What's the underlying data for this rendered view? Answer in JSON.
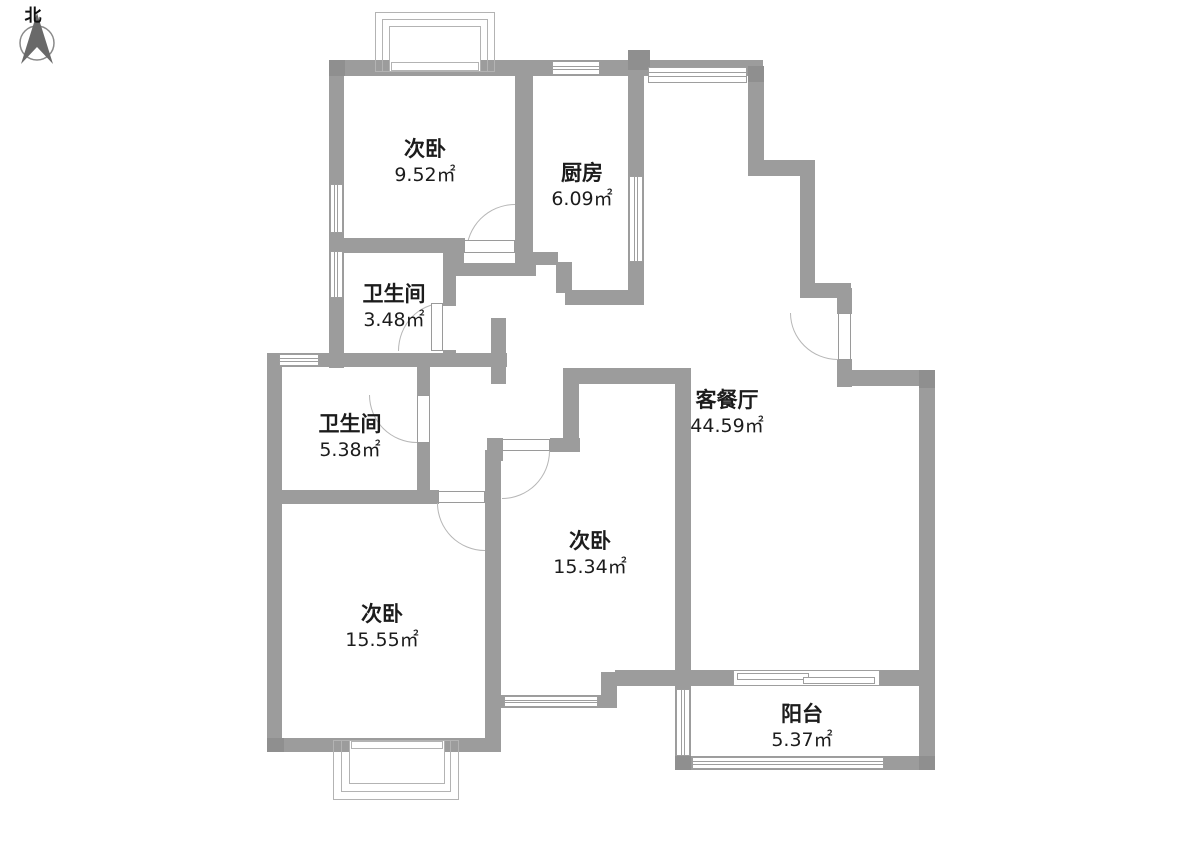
{
  "compass": {
    "label": "北"
  },
  "rooms": [
    {
      "id": "bedroom-north",
      "name": "次卧",
      "area": "9.52㎡"
    },
    {
      "id": "kitchen",
      "name": "厨房",
      "area": "6.09㎡"
    },
    {
      "id": "bathroom-north",
      "name": "卫生间",
      "area": "3.48㎡"
    },
    {
      "id": "bathroom-south",
      "name": "卫生间",
      "area": "5.38㎡"
    },
    {
      "id": "living-dining",
      "name": "客餐厅",
      "area": "44.59㎡"
    },
    {
      "id": "bedroom-middle",
      "name": "次卧",
      "area": "15.34㎡"
    },
    {
      "id": "bedroom-west",
      "name": "次卧",
      "area": "15.55㎡"
    },
    {
      "id": "balcony",
      "name": "阳台",
      "area": "5.37㎡"
    }
  ],
  "colors": {
    "wall": "#9c9c9c",
    "wall_dark": "#8f8f8f",
    "window_frame": "#9e9e9e",
    "door_arc": "#b6b6b6",
    "text": "#1c1c1c"
  }
}
